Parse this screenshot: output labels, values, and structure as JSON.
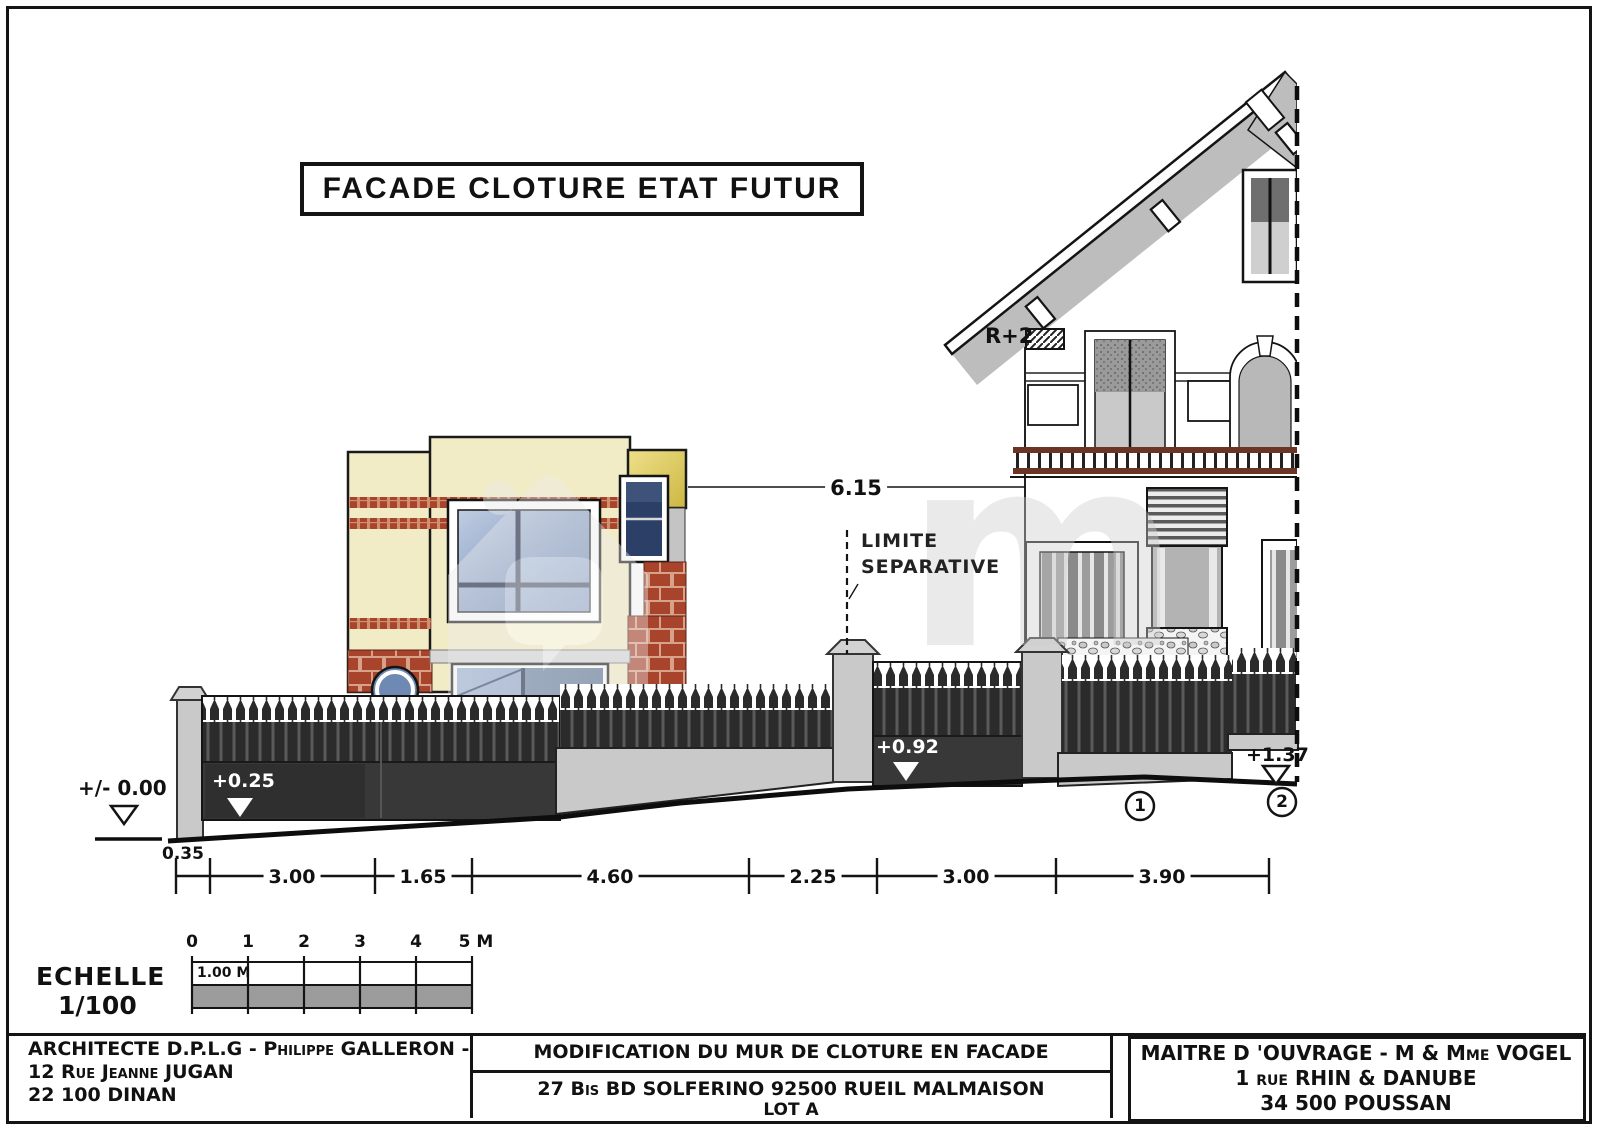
{
  "title": "FACADE CLOTURE ETAT FUTUR",
  "colors": {
    "cream_wall": "#f2ecc6",
    "brick_red": "#a8432c",
    "mustard": "#d8c253",
    "glass_blue": "#8fa5c8",
    "fence_dark": "#2e2e2e",
    "wall_gray": "#c9c9c9",
    "roof_gray": "#bdbdbd",
    "rail_brown": "#6b3526"
  },
  "annotations": {
    "storey_label": "R+2",
    "boundary_line1": "LIMITE",
    "boundary_line2": "SEPARATIVE",
    "gap_dimension": "6.15",
    "level_ground": "+/- 0.00",
    "level_gate1": "+0.25",
    "level_gate2": "+0.92",
    "level_wall": "+1.37",
    "marker_1": "1",
    "marker_2": "2",
    "offset_dim": "0.35"
  },
  "dimensions": {
    "segments": [
      "3.00",
      "1.65",
      "4.60",
      "2.25",
      "3.00",
      "3.90"
    ]
  },
  "scale_bar": {
    "title_line1": "ECHELLE",
    "title_line2": "1/100",
    "ticks": [
      "0",
      "1",
      "2",
      "3",
      "4",
      "5 M"
    ],
    "cell_label": "1.00 M"
  },
  "title_block": {
    "architect": {
      "line1": "ARCHITECTE D.P.L.G - Philippe GALLERON -",
      "line2": "12 Rue Jeanne JUGAN",
      "line3": "22 100 DINAN"
    },
    "project": {
      "title": "MODIFICATION DU MUR DE CLOTURE EN FACADE",
      "address": "27 Bis BD SOLFERINO 92500 RUEIL MALMAISON",
      "lot": "LOT A"
    },
    "owner": {
      "line1": "MAITRE D 'OUVRAGE - M & Mme  VOGEL",
      "line2": "1 rue RHIN & DANUBE",
      "line3": "34 500 POUSSAN"
    }
  }
}
